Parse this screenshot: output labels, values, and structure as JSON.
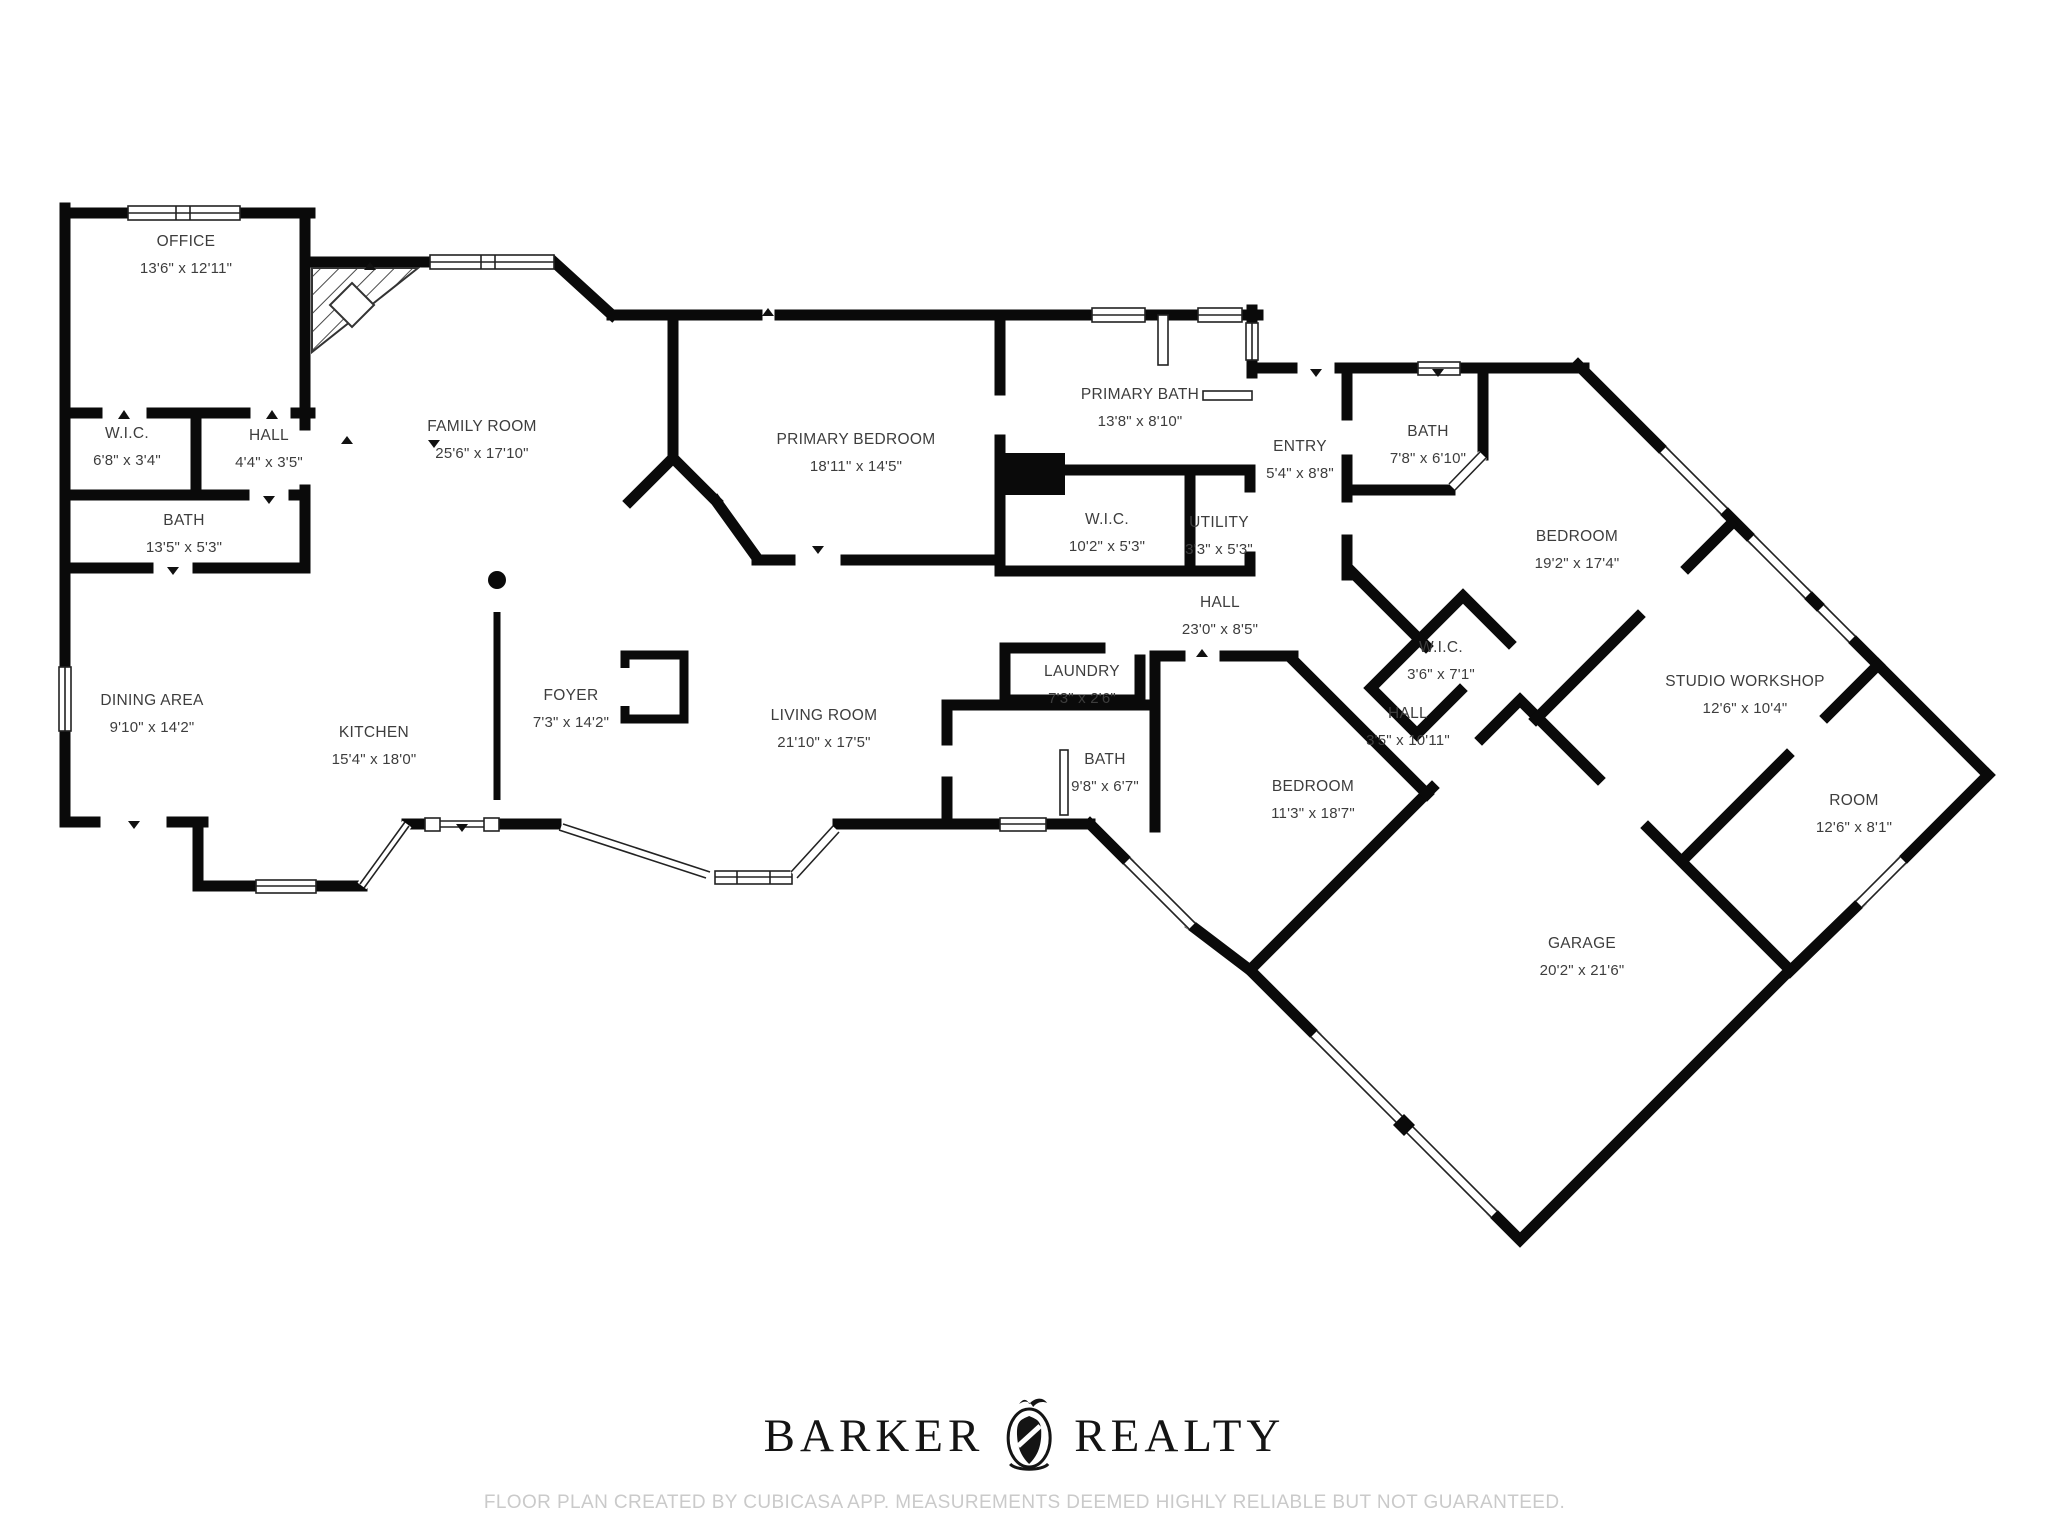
{
  "plan": {
    "rooms": [
      {
        "id": "office",
        "name": "OFFICE",
        "dims": "13'6\" x 12'11\""
      },
      {
        "id": "wic1",
        "name": "W.I.C.",
        "dims": "6'8\" x 3'4\""
      },
      {
        "id": "hall1",
        "name": "HALL",
        "dims": "4'4\" x 3'5\""
      },
      {
        "id": "bath1",
        "name": "BATH",
        "dims": "13'5\" x 5'3\""
      },
      {
        "id": "family-room",
        "name": "FAMILY ROOM",
        "dims": "25'6\" x 17'10\""
      },
      {
        "id": "primary-bedroom",
        "name": "PRIMARY BEDROOM",
        "dims": "18'11\" x 14'5\""
      },
      {
        "id": "primary-bath",
        "name": "PRIMARY BATH",
        "dims": "13'8\" x 8'10\""
      },
      {
        "id": "wic2",
        "name": "W.I.C.",
        "dims": "10'2\" x 5'3\""
      },
      {
        "id": "utility",
        "name": "UTILITY",
        "dims": "3'3\" x 5'3\""
      },
      {
        "id": "entry",
        "name": "ENTRY",
        "dims": "5'4\" x 8'8\""
      },
      {
        "id": "bath2",
        "name": "BATH",
        "dims": "7'8\" x 6'10\""
      },
      {
        "id": "bedroom2",
        "name": "BEDROOM",
        "dims": "19'2\" x 17'4\""
      },
      {
        "id": "hall2",
        "name": "HALL",
        "dims": "23'0\" x 8'5\""
      },
      {
        "id": "wic3",
        "name": "W.I.C.",
        "dims": "3'6\" x 7'1\""
      },
      {
        "id": "hall3",
        "name": "HALL",
        "dims": "3'5\" x 10'11\""
      },
      {
        "id": "studio-workshop",
        "name": "STUDIO WORKSHOP",
        "dims": "12'6\" x 10'4\""
      },
      {
        "id": "room",
        "name": "ROOM",
        "dims": "12'6\" x 8'1\""
      },
      {
        "id": "laundry",
        "name": "LAUNDRY",
        "dims": "7'3\" x 2'6\""
      },
      {
        "id": "bath3",
        "name": "BATH",
        "dims": "9'8\" x 6'7\""
      },
      {
        "id": "bedroom3",
        "name": "BEDROOM",
        "dims": "11'3\" x 18'7\""
      },
      {
        "id": "garage",
        "name": "GARAGE",
        "dims": "20'2\" x 21'6\""
      },
      {
        "id": "dining-area",
        "name": "DINING AREA",
        "dims": "9'10\" x 14'2\""
      },
      {
        "id": "kitchen",
        "name": "KITCHEN",
        "dims": "15'4\" x 18'0\""
      },
      {
        "id": "foyer",
        "name": "FOYER",
        "dims": "7'3\" x 14'2\""
      },
      {
        "id": "living-room",
        "name": "LIVING ROOM",
        "dims": "21'10\" x 17'5\""
      }
    ]
  },
  "footer": {
    "brand_word1": "BARKER",
    "brand_word2": "REALTY",
    "crest_icon": "heraldic-crest-icon",
    "disclaimer": "FLOOR PLAN CREATED BY CUBICASA APP. MEASUREMENTS DEEMED HIGHLY RELIABLE BUT NOT GUARANTEED."
  },
  "colors": {
    "wall": "#0a0a0a",
    "label_text": "#3d3d3d",
    "disclaimer_text": "#cacaca",
    "background": "#ffffff"
  }
}
